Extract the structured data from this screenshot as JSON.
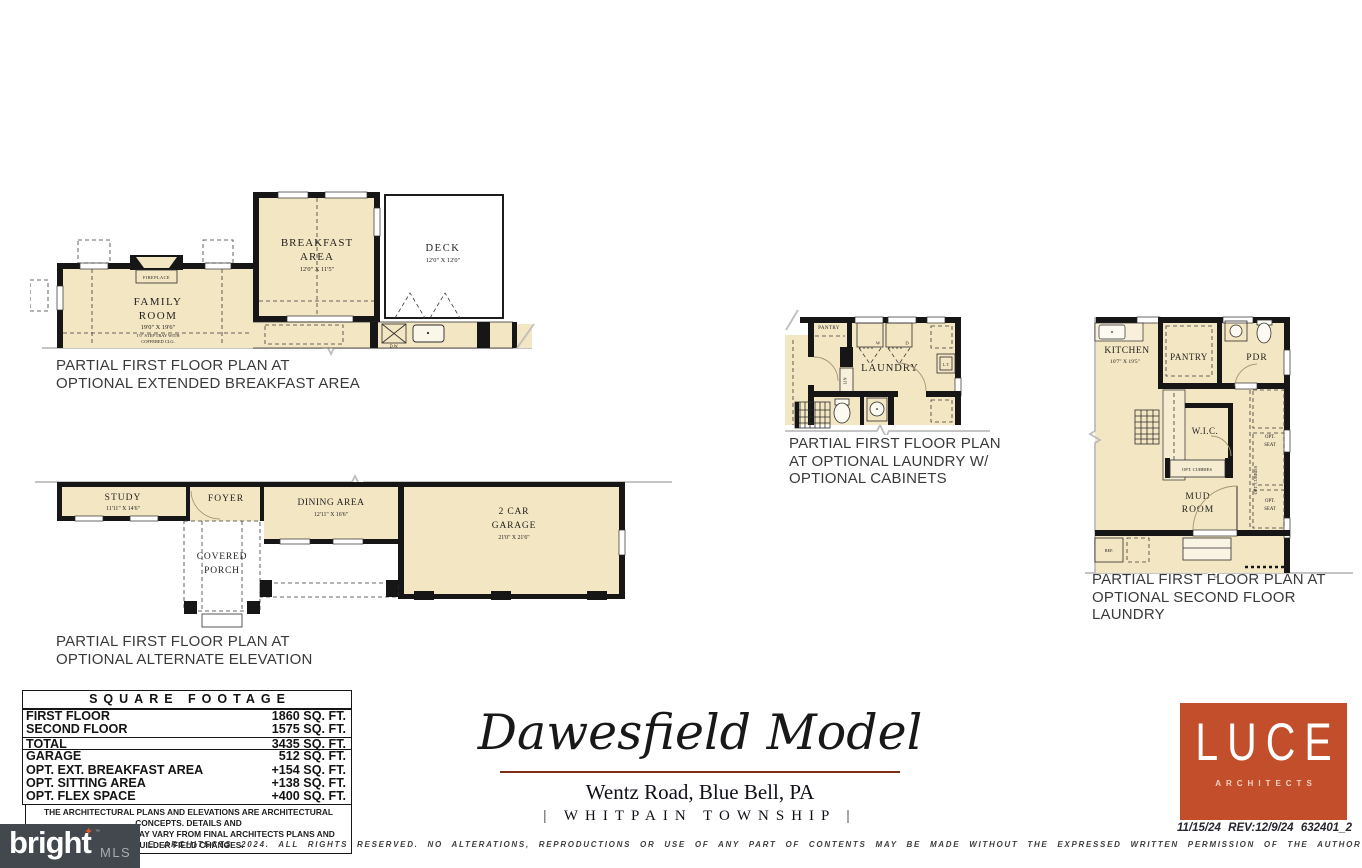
{
  "colors": {
    "brand_red": "#c24e2b",
    "title_rule": "#7d2c15",
    "room_fill": "#f3e6c3",
    "watermark_bg": "#43484e"
  },
  "plans": {
    "plan_a": {
      "caption1": "PARTIAL FIRST FLOOR PLAN AT",
      "caption2": "OPTIONAL EXTENDED BREAKFAST AREA",
      "family_room_1": "FAMILY",
      "family_room_2": "ROOM",
      "family_dims": "19'0\" X 19'6\"",
      "family_note1": "1'0\" STEP TRAY WITH",
      "family_note2": "COFFERED CLG.",
      "fireplace": "FIREPLACE",
      "breakfast_1": "BREAKFAST",
      "breakfast_2": "AREA",
      "breakfast_dims": "12'0\" X 11'5\"",
      "deck": "DECK",
      "deck_dims": "12'0\" X 12'0\"",
      "dw": "D.W."
    },
    "plan_b": {
      "caption1": "PARTIAL FIRST FLOOR PLAN AT",
      "caption2": "OPTIONAL ALTERNATE ELEVATION",
      "study": "STUDY",
      "study_dims": "11'11\" X 14'6\"",
      "foyer": "FOYER",
      "dining": "DINING AREA",
      "dining_dims": "12'11\" X 16'6\"",
      "garage_1": "2 CAR",
      "garage_2": "GARAGE",
      "garage_dims": "21'0\" X 21'6\"",
      "porch_1": "COVERED",
      "porch_2": "PORCH"
    },
    "plan_c": {
      "caption1": "PARTIAL FIRST FLOOR PLAN",
      "caption2": "AT OPTIONAL LAUNDRY W/",
      "caption3": "OPTIONAL CABINETS",
      "laundry": "LAUNDRY",
      "pantry": "PANTRY",
      "washer": "W",
      "dryer": "D",
      "linen": "LIN",
      "tub": "L.T."
    },
    "plan_d": {
      "caption1": "PARTIAL FIRST FLOOR PLAN AT",
      "caption2": "OPTIONAL SECOND FLOOR LAUNDRY",
      "kitchen": "KITCHEN",
      "kitchen_dims": "10'7\" X 19'5\"",
      "pantry": "PANTRY",
      "pdr": "PDR",
      "wic": "W.I.C.",
      "mud_1": "MUD",
      "mud_2": "ROOM",
      "cubbies": "OPT. CUBBIES",
      "cubbies_vertical": "OPT. CUBBIES",
      "seat_top_1": "OPT.",
      "seat_top_2": "SEAT",
      "seat_bottom_1": "OPT.",
      "seat_bottom_2": "SEAT",
      "ref": "REF."
    }
  },
  "square_footage": {
    "title": "SQUARE FOOTAGE",
    "rows": [
      {
        "label": "FIRST FLOOR",
        "value": "1860 SQ. FT."
      },
      {
        "label": "SECOND FLOOR",
        "value": "1575 SQ. FT."
      },
      {
        "label": "TOTAL",
        "value": "3435 SQ. FT."
      },
      {
        "label": "GARAGE",
        "value": "512 SQ. FT."
      },
      {
        "label": "OPT. EXT. BREAKFAST AREA",
        "value": "+154 SQ. FT."
      },
      {
        "label": "OPT. SITTING AREA",
        "value": "+138 SQ. FT."
      },
      {
        "label": "OPT. FLEX SPACE",
        "value": "+400 SQ. FT."
      }
    ],
    "disclaimer1": "THE ARCHITECTURAL PLANS AND ELEVATIONS ARE ARCHITECTURAL CONCEPTS. DETAILS AND",
    "disclaimer2": "DIMENSIONS SHOWN MAY VARY FROM FINAL ARCHITECTS PLANS AND BUILDER FIELD CHANGES."
  },
  "title_block": {
    "model_name": "Dawesfield Model",
    "address": "Wentz Road, Blue Bell, PA",
    "township": "| WHITPAIN TOWNSHIP |"
  },
  "architect": {
    "name": "LUCE",
    "sub": "ARCHITECTS",
    "date": "11/15/24",
    "revision": "REV:12/9/24",
    "job_number": "632401_2"
  },
  "watermark": {
    "brand": "bright",
    "mls": "MLS",
    "tm": "™"
  },
  "footer": {
    "copyright": "E ARCHITECTS 2024.  ALL RIGHTS RESERVED.  NO ALTERATIONS, REPRODUCTIONS OR USE OF ANY PART OF CONTENTS MAY BE MADE WITHOUT THE EXPRESSED WRITTEN PERMISSION OF THE AUTHOR"
  }
}
